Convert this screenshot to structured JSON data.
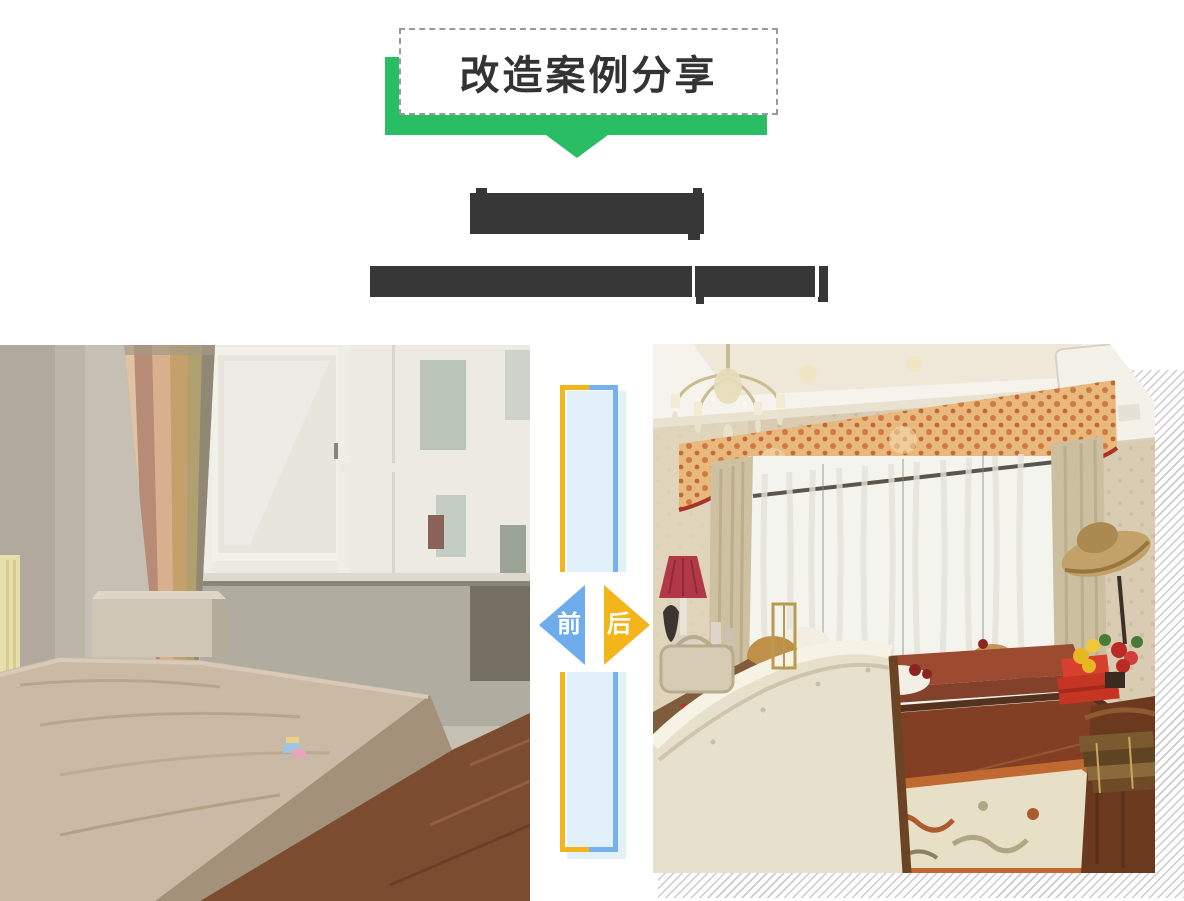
{
  "banner": {
    "title": "改造案例分享",
    "ribbon_color": "#29BE63",
    "box_border_color": "#9A9A9A",
    "title_color": "#333333"
  },
  "article": {
    "headline_redacted_mask": "████████",
    "subheadline_redacted_mask": "███████████████",
    "redaction_color": "#373737"
  },
  "comparison": {
    "before_label": "前",
    "after_label": "后",
    "before_arrow_color": "#6FACEB",
    "after_arrow_color": "#F2B51B",
    "frame_yellow": "#F2B51B",
    "frame_blue": "#76B1ED",
    "frame_shadow_color": "#E2F0F9",
    "hatch_line_color": "#CCCCCC",
    "before_photo_description": "改造前：旧卧室，裸床垫、白色窗框大窗、粉色条纹窗帘、小床头柜",
    "after_photo_description": "改造后：欧式卧室，水晶吊灯、空调、橙色花纹窗幔飘窗、米色皮床、花纹地毯、木质边柜"
  }
}
